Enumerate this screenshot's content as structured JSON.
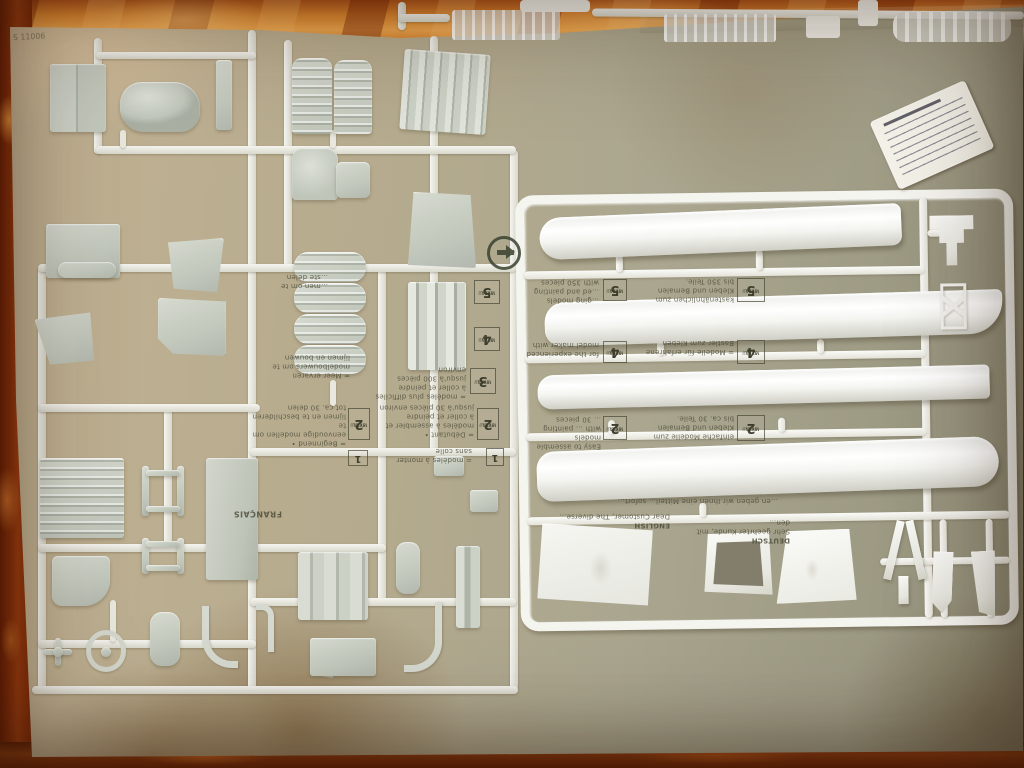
{
  "colors": {
    "fabric_orange": "#d9832e",
    "fabric_dark": "#7c2a08",
    "cardboard_tan": "#b5aa8d",
    "plastic_white": "#f5f5f0",
    "plastic_gray": "#c8cec4",
    "ink": "#4b4b38",
    "sticker_white": "#f3f1e8",
    "green_dot_ink": "#39422f"
  },
  "cardboard": {
    "code": "S 11006"
  },
  "skill_chart": {
    "niveau": "NIVEAU",
    "skill": "SKILL",
    "lv1": "1",
    "lv2": "2",
    "lv3": "3",
    "lv4": "4",
    "lv5": "5"
  },
  "print": {
    "frag_nl_a": "…men om te\n…ste delen",
    "frag_nl_b": "= Meer ervaren\nmodelbouwers om te\nlijmen en bouwen",
    "nl2": "= Beginnend •\neenvoudige modellen om te\nlijmen en te beschilderen\ntot ca. 30 delen",
    "fr2": "= Débutant •\nmodèles à assembler et\nà coller et peindre\njusqu'à 30 pièces environ",
    "fr3": "= modèles plus difficiles\nà coller et peindre\njusqu'à 300 pièces environ",
    "fr1": "= modèles à monter\nsans colle",
    "francais": "FRANÇAIS",
    "en5": "…ging models\n…ed and painting\nwith 350 pieces",
    "de5": "kastenähnlichen zum\nKleben und Bemalen\nbis 350 Teile.",
    "en4": "for the experienced\nmodel maker with",
    "de4": "= Modelle für erfahrene\nBastler zum Kleben",
    "en2": "Easy to assemble models\nwith … painting\n… 30 pieces",
    "de2": "einfache Modelle zum\nKleben und Bemalen\nbis ca. 30 Teile.",
    "de_line": "…en geben wir Ihnen eine Mitteil… sofort…"
  },
  "customer_note": {
    "english_hdr": "ENGLISH",
    "english_body": "Dear Customer, The diverse…",
    "deutsch_hdr": "DEUTSCH",
    "deutsch_body": "Sehr geehrter Kunde, mit den…"
  }
}
